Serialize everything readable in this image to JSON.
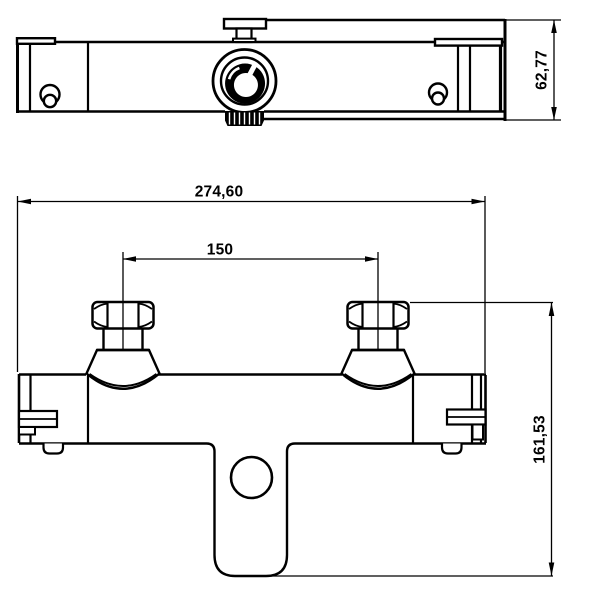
{
  "meta": {
    "background_color": "#ffffff",
    "line_color": "#000000",
    "drawing_type": "technical dimension drawing, thermostatic shower mixer"
  },
  "dimensions": {
    "body_depth": "62,77",
    "overall_width": "274,60",
    "inlet_spacing": "150",
    "inlet_to_spout_height": "161,53"
  }
}
